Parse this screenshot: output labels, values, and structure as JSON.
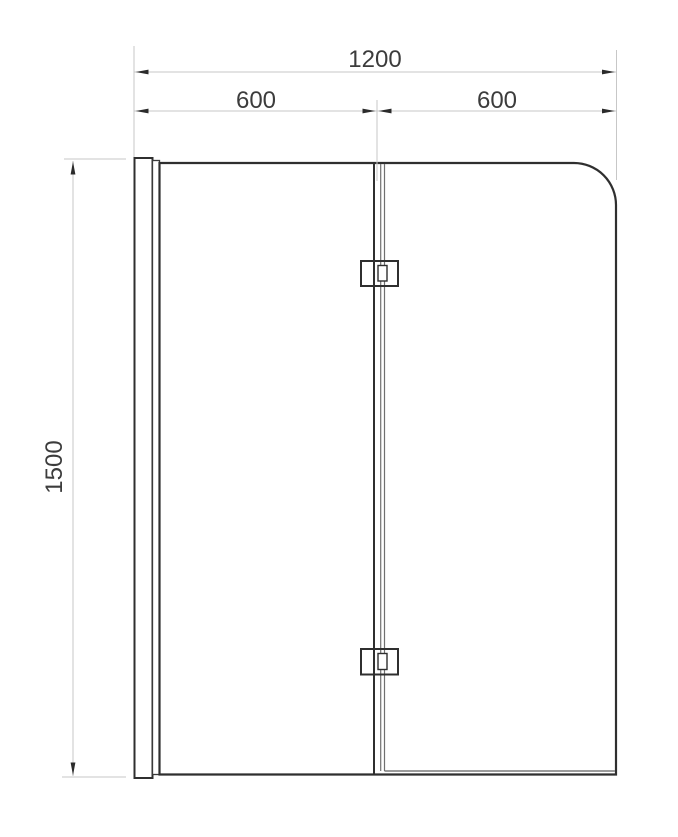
{
  "diagram": {
    "type": "technical-drawing",
    "subject": "two-panel folding bath shower screen, front elevation",
    "labels": {
      "total_width": "1200",
      "left_panel_width": "600",
      "right_panel_width": "600",
      "height": "1500"
    },
    "colors": {
      "background": "#ffffff",
      "drawing_line": "#2f2f2f",
      "secondary_line": "#707070",
      "dimension_line": "#c7c7c7",
      "arrow": "#2b2b2b",
      "text": "#3c3c3c"
    },
    "parts": [
      "wall-profile",
      "fixed-left-panel",
      "hinged-right-panel",
      "top-hinge",
      "bottom-hinge",
      "bottom-seal"
    ]
  }
}
